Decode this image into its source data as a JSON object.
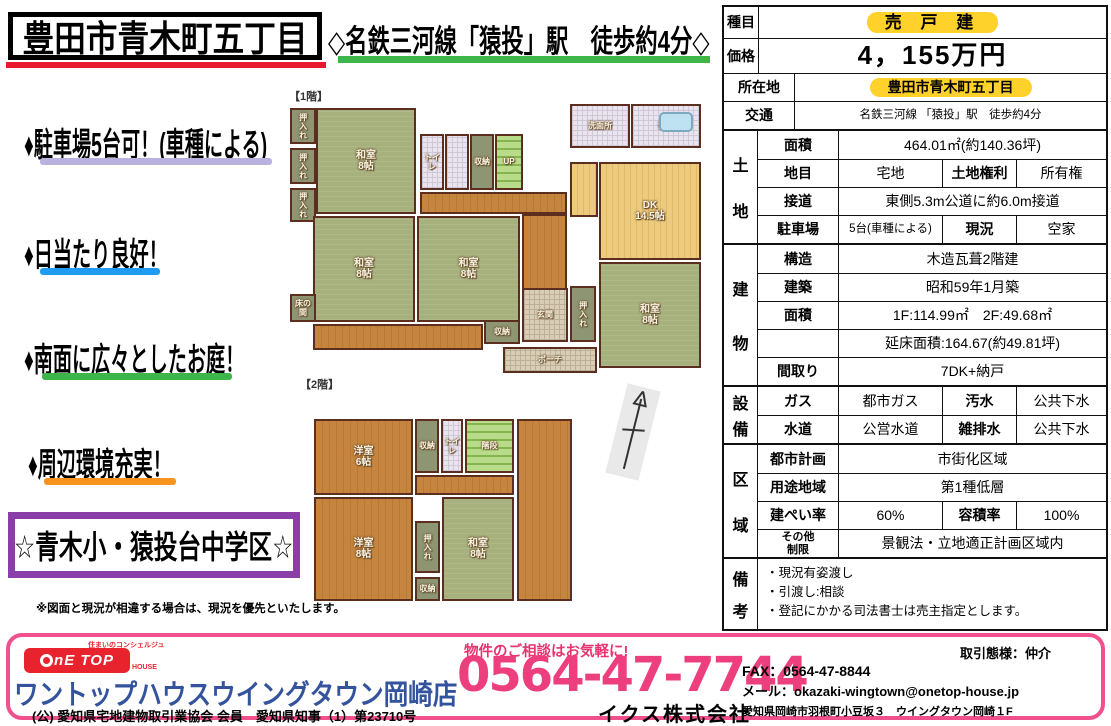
{
  "header": {
    "title": "豊田市青木町五丁目",
    "station": "◇名鉄三河線「猿投」駅　徒歩約4分◇"
  },
  "highlights": [
    {
      "text": "♦駐車場5台可！(車種による)",
      "underline_color": "#b9b1de",
      "x": 24,
      "y": 118,
      "bar_x": 40,
      "bar_y": 158,
      "bar_w": 232
    },
    {
      "text": "♦日当たり良好！",
      "underline_color": "#1f9cf0",
      "x": 24,
      "y": 228,
      "bar_x": 40,
      "bar_y": 268,
      "bar_w": 120
    },
    {
      "text": "♦南面に広々としたお庭！",
      "underline_color": "#3cb54a",
      "x": 24,
      "y": 333,
      "bar_x": 42,
      "bar_y": 373,
      "bar_w": 190
    },
    {
      "text": "♦周辺環境充実！",
      "underline_color": "#f7941d",
      "x": 28,
      "y": 438,
      "bar_x": 44,
      "bar_y": 478,
      "bar_w": 132
    }
  ],
  "school_box": "☆青木小・猿投台中学区☆",
  "disclaimer": "※図面と現況が相違する場合は、現況を優先といたします。",
  "floorplans": {
    "floor1_label": "【1階】",
    "floor2_label": "【2階】",
    "floor1_rooms": [
      {
        "x": 2,
        "y": 8,
        "w": 26,
        "h": 36,
        "t": "押入れ",
        "c": "olive",
        "vert": true,
        "sm": true
      },
      {
        "x": 2,
        "y": 48,
        "w": 26,
        "h": 36,
        "t": "押入れ",
        "c": "olive",
        "vert": true,
        "sm": true
      },
      {
        "x": 2,
        "y": 88,
        "w": 26,
        "h": 34,
        "t": "押入れ",
        "c": "olive",
        "vert": true,
        "sm": true
      },
      {
        "x": 28,
        "y": 8,
        "w": 100,
        "h": 106,
        "t": "和室\n8帖",
        "c": "tatami"
      },
      {
        "x": 132,
        "y": 34,
        "w": 24,
        "h": 56,
        "t": "トイレ",
        "c": "btile",
        "sm": true
      },
      {
        "x": 157,
        "y": 34,
        "w": 24,
        "h": 56,
        "t": "",
        "c": "btile"
      },
      {
        "x": 182,
        "y": 34,
        "w": 24,
        "h": 56,
        "t": "収納",
        "c": "olive",
        "sm": true
      },
      {
        "x": 207,
        "y": 34,
        "w": 28,
        "h": 56,
        "t": "UP",
        "c": "stairs",
        "sm": true
      },
      {
        "x": 132,
        "y": 92,
        "w": 147,
        "h": 22,
        "t": "",
        "c": "wood"
      },
      {
        "x": 25,
        "y": 116,
        "w": 102,
        "h": 106,
        "t": "和室\n8帖",
        "c": "tatami"
      },
      {
        "x": 129,
        "y": 116,
        "w": 103,
        "h": 106,
        "t": "和室\n8帖",
        "c": "tatami"
      },
      {
        "x": 234,
        "y": 114,
        "w": 45,
        "h": 80,
        "t": "",
        "c": "wood"
      },
      {
        "x": 282,
        "y": 4,
        "w": 60,
        "h": 44,
        "t": "洗面所",
        "c": "btile",
        "sm": true
      },
      {
        "x": 343,
        "y": 4,
        "w": 70,
        "h": 44,
        "t": "浴室",
        "c": "btile",
        "sm": true,
        "icon": "tub"
      },
      {
        "x": 282,
        "y": 62,
        "w": 28,
        "h": 55,
        "t": "",
        "c": "lightwood"
      },
      {
        "x": 311,
        "y": 62,
        "w": 102,
        "h": 98,
        "t": "DK\n14.5帖",
        "c": "lightwood"
      },
      {
        "x": 282,
        "y": 186,
        "w": 26,
        "h": 56,
        "t": "押入れ",
        "c": "olive",
        "vert": true,
        "sm": true
      },
      {
        "x": 234,
        "y": 188,
        "w": 46,
        "h": 54,
        "t": "玄関",
        "c": "tile",
        "sm": true
      },
      {
        "x": 311,
        "y": 162,
        "w": 102,
        "h": 106,
        "t": "和室\n8帖",
        "c": "tatami"
      },
      {
        "x": 215,
        "y": 247,
        "w": 94,
        "h": 26,
        "t": "ポーチ",
        "c": "tile",
        "sm": true
      },
      {
        "x": 196,
        "y": 220,
        "w": 36,
        "h": 24,
        "t": "収納",
        "c": "olive",
        "sm": true
      },
      {
        "x": 25,
        "y": 224,
        "w": 170,
        "h": 26,
        "t": "",
        "c": "wood"
      },
      {
        "x": 2,
        "y": 194,
        "w": 26,
        "h": 28,
        "t": "床の間",
        "c": "olive",
        "sm": true
      }
    ],
    "floor2_rooms": [
      {
        "x": 2,
        "y": 2,
        "w": 99,
        "h": 76,
        "t": "洋室\n6帖",
        "c": "wood"
      },
      {
        "x": 103,
        "y": 2,
        "w": 24,
        "h": 54,
        "t": "収納",
        "c": "olive",
        "sm": true
      },
      {
        "x": 129,
        "y": 2,
        "w": 22,
        "h": 54,
        "t": "トイレ",
        "c": "btile",
        "sm": true
      },
      {
        "x": 153,
        "y": 2,
        "w": 49,
        "h": 54,
        "t": "階段",
        "c": "stairs",
        "sm": true
      },
      {
        "x": 205,
        "y": 2,
        "w": 55,
        "h": 182,
        "t": "",
        "c": "wood"
      },
      {
        "x": 103,
        "y": 58,
        "w": 99,
        "h": 20,
        "t": "",
        "c": "wood"
      },
      {
        "x": 2,
        "y": 80,
        "w": 99,
        "h": 104,
        "t": "洋室\n8帖",
        "c": "wood"
      },
      {
        "x": 103,
        "y": 104,
        "w": 25,
        "h": 52,
        "t": "押入れ",
        "c": "olive",
        "vert": true,
        "sm": true
      },
      {
        "x": 103,
        "y": 160,
        "w": 25,
        "h": 24,
        "t": "収納",
        "c": "olive",
        "sm": true
      },
      {
        "x": 130,
        "y": 80,
        "w": 72,
        "h": 104,
        "t": "和室\n8帖",
        "c": "tatami"
      }
    ]
  },
  "property_table": {
    "highlight_color": "#ffd12b",
    "top_rows": [
      {
        "h": 31,
        "cells": [
          {
            "k": "ga",
            "t": "種目"
          },
          {
            "k": "v",
            "t": "売 戸 建",
            "hl": true,
            "hlwide": true
          }
        ]
      },
      {
        "h": 35,
        "cells": [
          {
            "k": "ga",
            "t": "価格"
          },
          {
            "k": "v",
            "t": "4，155万円",
            "cls": "price"
          }
        ]
      },
      {
        "h": 28,
        "cells": [
          {
            "k": "wl",
            "t": "所在地"
          },
          {
            "k": "v",
            "t": "豊田市青木町五丁目",
            "hl": true
          }
        ]
      },
      {
        "h": 28,
        "cells": [
          {
            "k": "wl",
            "t": "交通"
          },
          {
            "k": "v",
            "t": "名鉄三河線 「猿投」駅　徒歩約4分",
            "cls": "sm"
          }
        ]
      }
    ],
    "groups": [
      {
        "label": "土地",
        "rows": [
          {
            "h": 28,
            "cells": [
              {
                "k": "l",
                "t": "面積"
              },
              {
                "k": "v",
                "t": "464.01㎡(約140.36坪)"
              }
            ]
          },
          {
            "h": 28,
            "cells": [
              {
                "k": "l",
                "t": "地目"
              },
              {
                "k": "v2",
                "t": "宅地"
              },
              {
                "k": "l2",
                "t": "土地権利"
              },
              {
                "k": "v3",
                "t": "所有権"
              }
            ]
          },
          {
            "h": 28,
            "cells": [
              {
                "k": "l",
                "t": "接道"
              },
              {
                "k": "v",
                "t": "東側5.3m公道に約6.0m接道"
              }
            ]
          },
          {
            "h": 28,
            "cells": [
              {
                "k": "l",
                "t": "駐車場"
              },
              {
                "k": "v2",
                "t": "5台(車種による)",
                "cls": "sm"
              },
              {
                "k": "l2",
                "t": "現況"
              },
              {
                "k": "v3",
                "t": "空家"
              }
            ]
          }
        ]
      },
      {
        "label": "建物",
        "rows": [
          {
            "h": 28,
            "cells": [
              {
                "k": "l",
                "t": "構造"
              },
              {
                "k": "v",
                "t": "木造瓦葺2階建"
              }
            ]
          },
          {
            "h": 28,
            "cells": [
              {
                "k": "l",
                "t": "建築"
              },
              {
                "k": "v",
                "t": "昭和59年1月築"
              }
            ]
          },
          {
            "h": 28,
            "cells": [
              {
                "k": "l",
                "t": "面積"
              },
              {
                "k": "v",
                "t": "1F:114.99㎡　2F:49.68㎡"
              }
            ]
          },
          {
            "h": 28,
            "cells": [
              {
                "k": "l",
                "t": ""
              },
              {
                "k": "v",
                "t": "延床面積:164.67(約49.81坪)"
              }
            ]
          },
          {
            "h": 28,
            "cells": [
              {
                "k": "l",
                "t": "間取り"
              },
              {
                "k": "v",
                "t": "7DK+納戸"
              }
            ]
          }
        ]
      },
      {
        "label": "設備",
        "rows": [
          {
            "h": 28,
            "cells": [
              {
                "k": "l",
                "t": "ガス"
              },
              {
                "k": "v2",
                "t": "都市ガス"
              },
              {
                "k": "l2",
                "t": "汚水"
              },
              {
                "k": "v3",
                "t": "公共下水"
              }
            ]
          },
          {
            "h": 28,
            "cells": [
              {
                "k": "l",
                "t": "水道"
              },
              {
                "k": "v2",
                "t": "公営水道"
              },
              {
                "k": "l2",
                "t": "雑排水"
              },
              {
                "k": "v3",
                "t": "公共下水"
              }
            ]
          }
        ]
      },
      {
        "label": "区域",
        "rows": [
          {
            "h": 28,
            "cells": [
              {
                "k": "l",
                "t": "都市計画"
              },
              {
                "k": "v",
                "t": "市街化区域"
              }
            ]
          },
          {
            "h": 28,
            "cells": [
              {
                "k": "l",
                "t": "用途地域"
              },
              {
                "k": "v",
                "t": "第1種低層"
              }
            ]
          },
          {
            "h": 28,
            "cells": [
              {
                "k": "l",
                "t": "建ぺい率"
              },
              {
                "k": "v2",
                "t": "60%"
              },
              {
                "k": "l2",
                "t": "容積率"
              },
              {
                "k": "v3",
                "t": "100%"
              }
            ]
          },
          {
            "h": 28,
            "cells": [
              {
                "k": "l",
                "t": "その他\n制限",
                "cls": "xs"
              },
              {
                "k": "v",
                "t": "景観法・立地適正計画区域内"
              }
            ]
          }
        ]
      },
      {
        "label": "備考",
        "rows": [
          {
            "h": 70,
            "cells": [
              {
                "k": "v",
                "t": "・現況有姿渡し\n・引渡し:相談\n・登記にかかる司法書士は売主指定とします。",
                "cls": "remarks"
              }
            ]
          }
        ]
      }
    ]
  },
  "footer": {
    "logo_note": "住まいのコンシェルジュ",
    "logo_text": "nE TOP",
    "logo_house": "HOUSE",
    "company": "ワントップハウスウイングタウン岡崎店",
    "membership": "(公) 愛知県宅地建物取引業協会 会員　愛知県知事（1）第23710号",
    "consult": "物件のご相談はお気軽に!",
    "phone": "0564-47-7744",
    "company2": "イクス株式会社",
    "torihiki": "取引態様：仲介",
    "fax": "FAX：0564-47-8844",
    "mail": "メール：okazaki-wingtown@onetop-house.jp",
    "address": "愛知県岡崎市羽根町小豆坂３　ウイングタウン岡崎１F"
  }
}
